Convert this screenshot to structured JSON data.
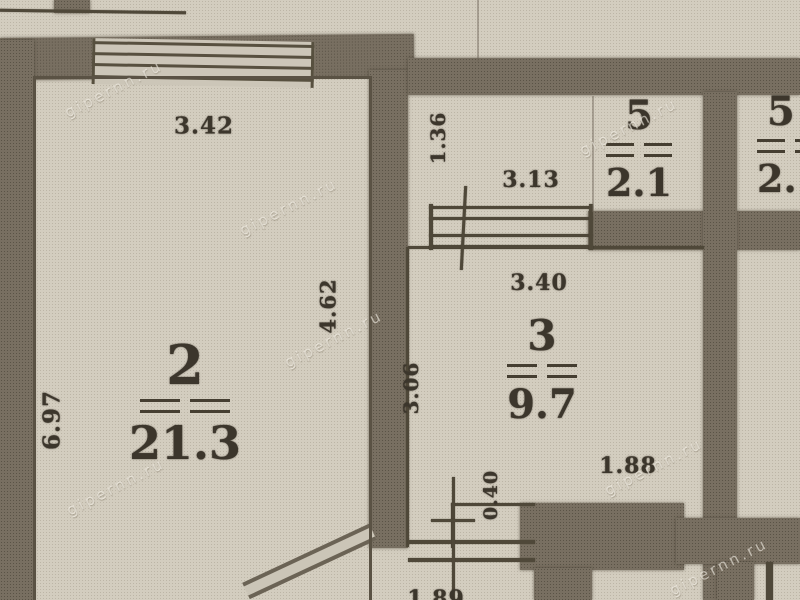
{
  "plan": {
    "watermark": "gipernn.ru",
    "rooms": {
      "room2": {
        "number": "2",
        "area": "21.3"
      },
      "room3": {
        "number": "3",
        "area": "9.7"
      },
      "room5": {
        "number": "5",
        "area": "2.1"
      },
      "room5b": {
        "number": "5",
        "area": "2."
      }
    },
    "dimensions": {
      "room2_width": "3.42",
      "room2_height": "6.97",
      "room2_right_wall": "4.62",
      "hall_height": "1.36",
      "hall_width": "3.13",
      "room3_width": "3.40",
      "room3_height": "3.06",
      "notch_height": "0.40",
      "notch_width": "1.88",
      "bottom_partial": "1.89"
    }
  }
}
